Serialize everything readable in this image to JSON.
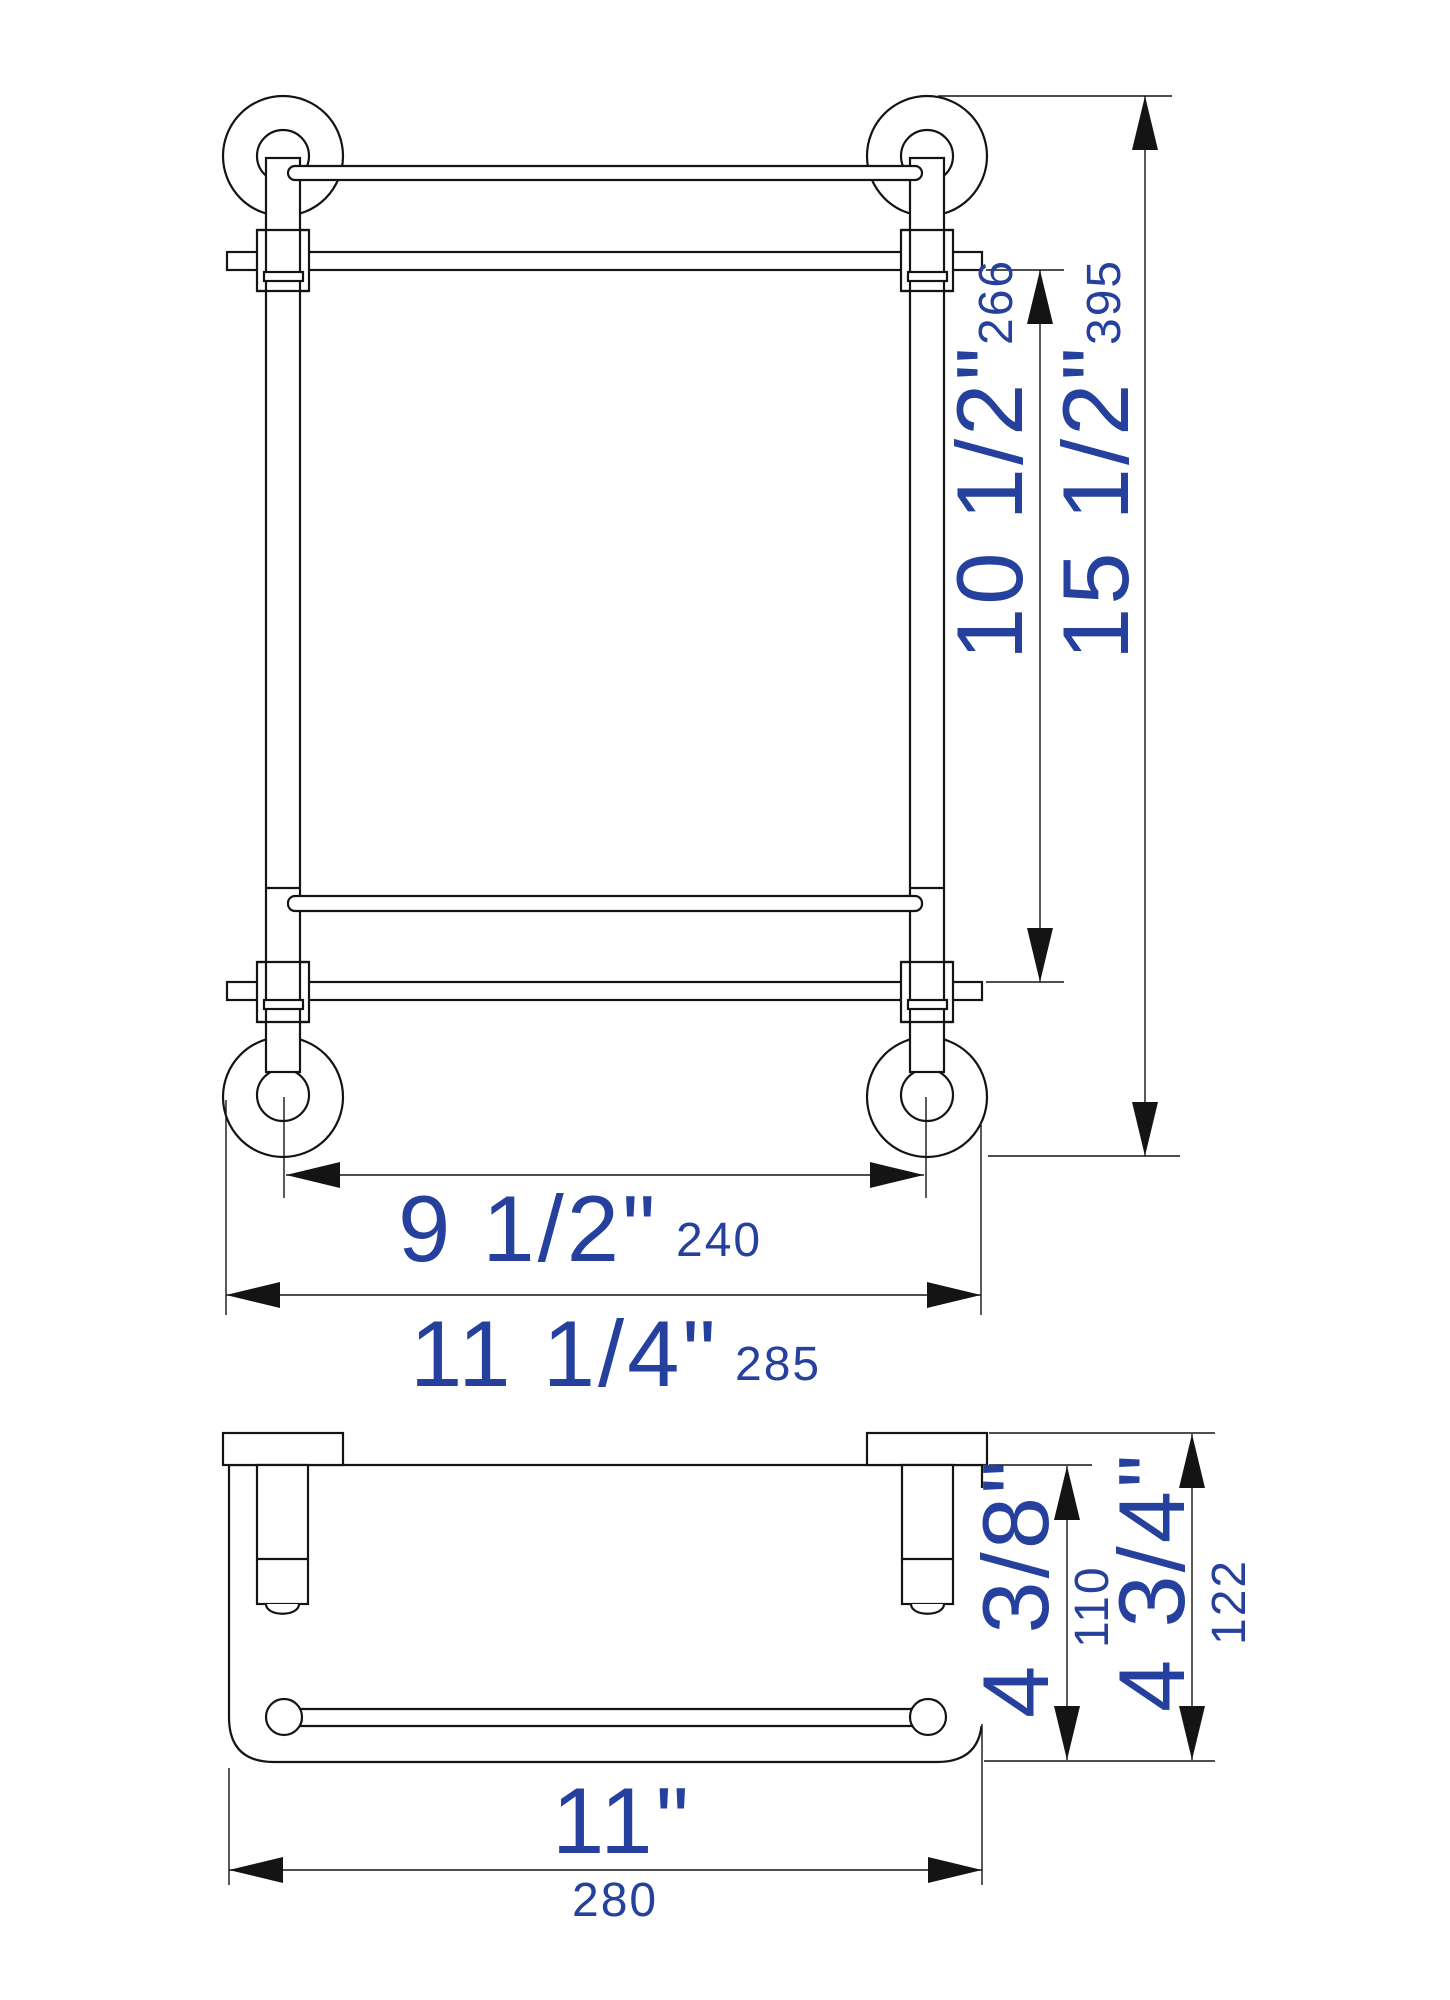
{
  "front_view": {
    "shelf_spacing": {
      "inches": "10 1/2\"",
      "mm": "266"
    },
    "overall_height": {
      "inches": "15 1/2\"",
      "mm": "395"
    },
    "post_center_width": {
      "inches": "9 1/2\"",
      "mm": "240"
    },
    "overall_width": {
      "inches": "11 1/4\"",
      "mm": "285"
    }
  },
  "side_view": {
    "shelf_depth": {
      "inches": "4 3/8\"",
      "mm": "110"
    },
    "overall_depth": {
      "inches": "4 3/4\"",
      "mm": "122"
    },
    "shelf_width": {
      "inches": "11\"",
      "mm": "280"
    }
  },
  "colors": {
    "dimension_text": "#25409d",
    "line": "#141414",
    "background": "#ffffff"
  }
}
